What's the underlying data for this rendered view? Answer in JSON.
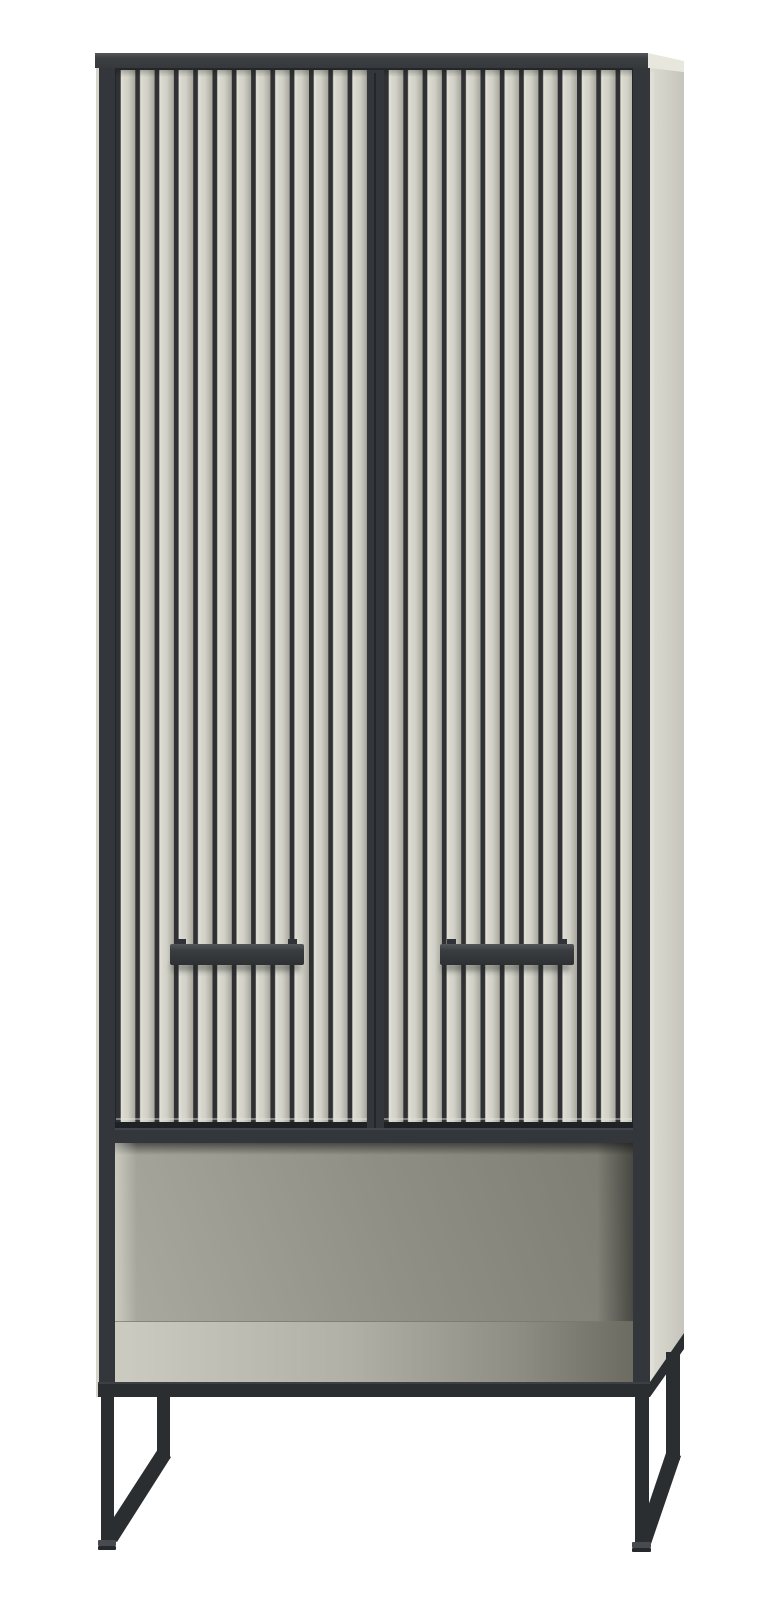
{
  "image": {
    "type": "product-photo",
    "subject": "Tall two-door storage cabinet with vertical slatted fronts, black frame, black bar handles, open lower shelf niche and black metal sled legs on a white background",
    "background": "#ffffff"
  },
  "cabinet": {
    "parts": {
      "top_panel": "top panel",
      "left_door": "left slatted door",
      "right_door": "right slatted door",
      "left_handle": "left bar handle",
      "right_handle": "right bar handle",
      "center_stile": "center door stile",
      "divider": "divider shelf band",
      "open_shelf": "open shelf niche",
      "side_panel": "right side panel",
      "base_rail": "base rail",
      "left_leg": "left sled leg",
      "right_leg": "right sled leg"
    },
    "colors": {
      "frame": "#33363a",
      "legs": "#2b2e31",
      "top_panel": "#3c3f42",
      "slat": "#d6d5cc",
      "groove": "#2f3134",
      "side_panel": "#d2d1c8",
      "niche_back": "#8d8c82",
      "niche_floor": "#b1b0a6",
      "handle": "#3a3d40",
      "background": "#ffffff"
    }
  }
}
